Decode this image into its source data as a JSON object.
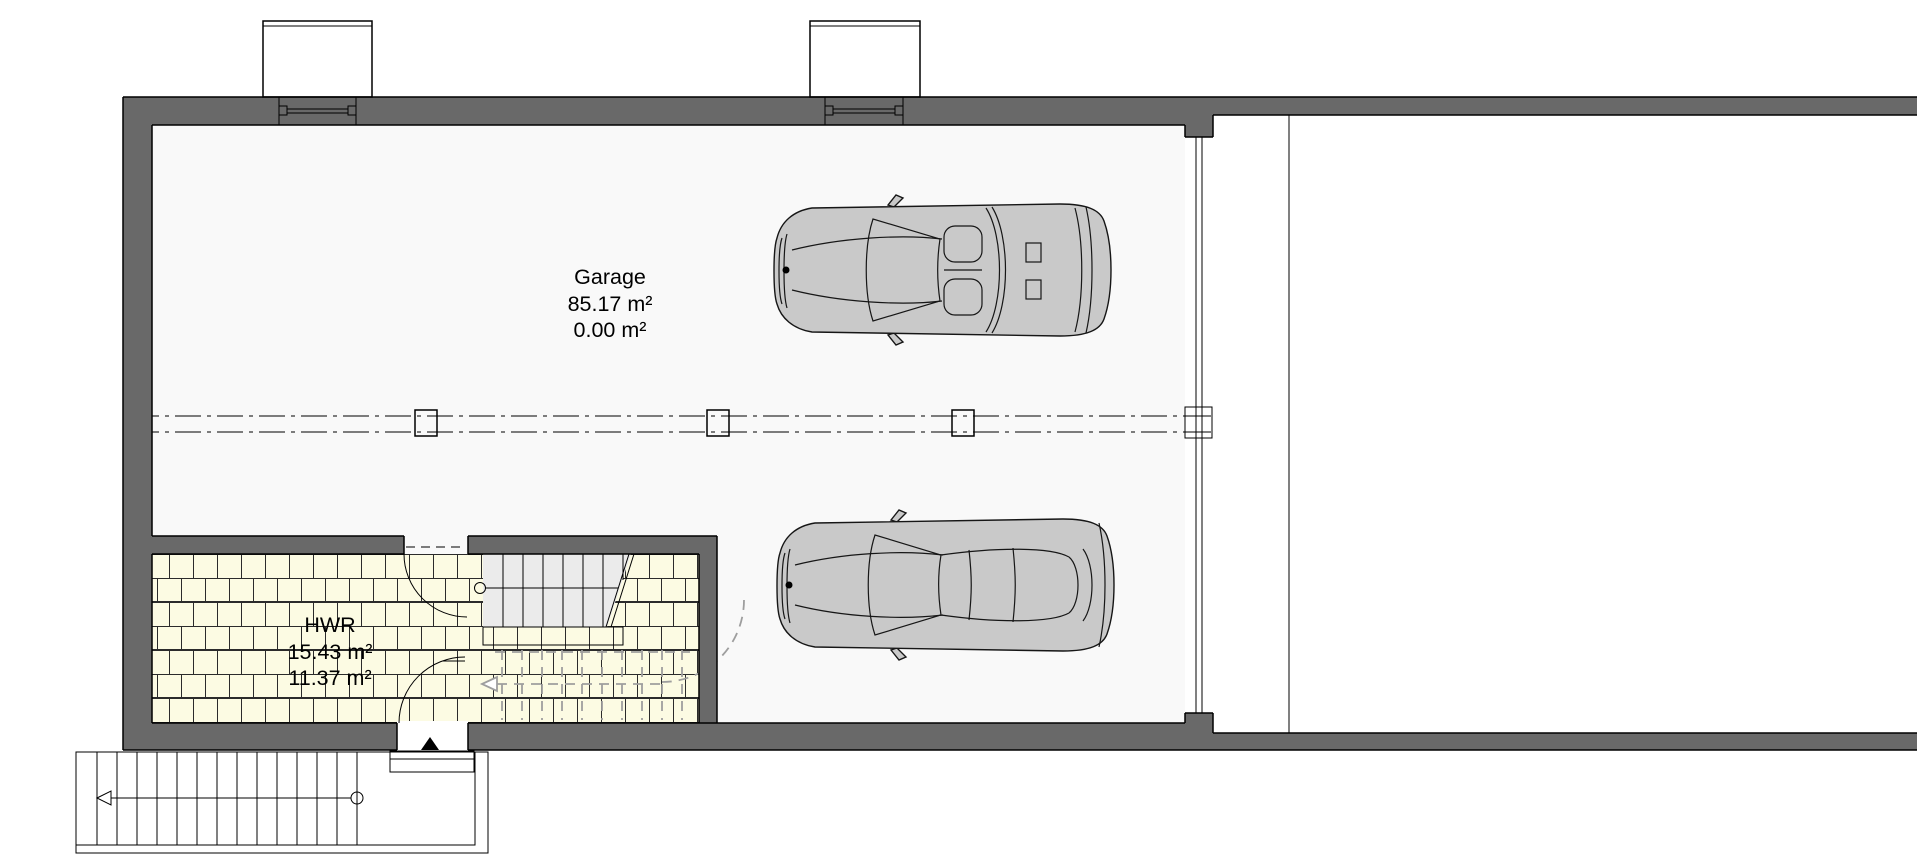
{
  "view": {
    "type": "floor-plan",
    "floor": "basement-garage-level"
  },
  "rooms": {
    "garage": {
      "label": "Garage",
      "area_total": "85.17 m²",
      "area_secondary": "0.00 m²"
    },
    "hwr": {
      "label": "HWR",
      "area_total": "15.43 m²",
      "area_secondary": "11.37 m²"
    }
  },
  "symbols": {
    "entrance_marker": "solid triangle pointing up at entry door",
    "exterior_stair_arrow": "open arrow pointing left along stair walk line",
    "stair_hidden_run": "gray dashed flight below cut plane",
    "axis_line": "double dash-dot center axis with column boxes"
  },
  "colors": {
    "bg": "#FFFFFF",
    "wall": "#696969",
    "floor": "#F9F9F9",
    "tile": "#FCFBE3",
    "tile_line": "#2B2B2B",
    "stair": "#EBEBEB",
    "car": "#C9C9C9",
    "glass": "#FFFFFF",
    "hidden": "#9E9E9E",
    "line": "#000000"
  }
}
